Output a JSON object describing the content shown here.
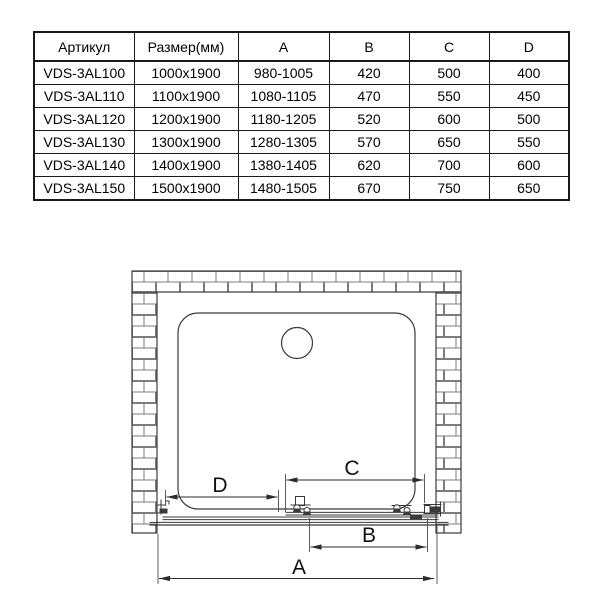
{
  "table": {
    "headers": [
      "Артикул",
      "Размер(мм)",
      "A",
      "B",
      "C",
      "D"
    ],
    "rows": [
      [
        "VDS-3AL100",
        "1000x1900",
        "980-1005",
        "420",
        "500",
        "400"
      ],
      [
        "VDS-3AL110",
        "1100x1900",
        "1080-1105",
        "470",
        "550",
        "450"
      ],
      [
        "VDS-3AL120",
        "1200x1900",
        "1180-1205",
        "520",
        "600",
        "500"
      ],
      [
        "VDS-3AL130",
        "1300x1900",
        "1280-1305",
        "570",
        "650",
        "550"
      ],
      [
        "VDS-3AL140",
        "1400x1900",
        "1380-1405",
        "620",
        "700",
        "600"
      ],
      [
        "VDS-3AL150",
        "1500x1900",
        "1480-1505",
        "670",
        "750",
        "650"
      ]
    ]
  },
  "diagram": {
    "type": "technical-drawing",
    "description": "Top view: sliding shower door mounted in a niche between brick walls, with shower tray, drain and dimension lines",
    "dim_labels": {
      "a": "A",
      "b": "B",
      "c": "C",
      "d": "D"
    }
  },
  "colors": {
    "line": "#3a3a3a",
    "brick_line": "#7d7d7d",
    "text": "#000000",
    "background": "#ffffff"
  }
}
